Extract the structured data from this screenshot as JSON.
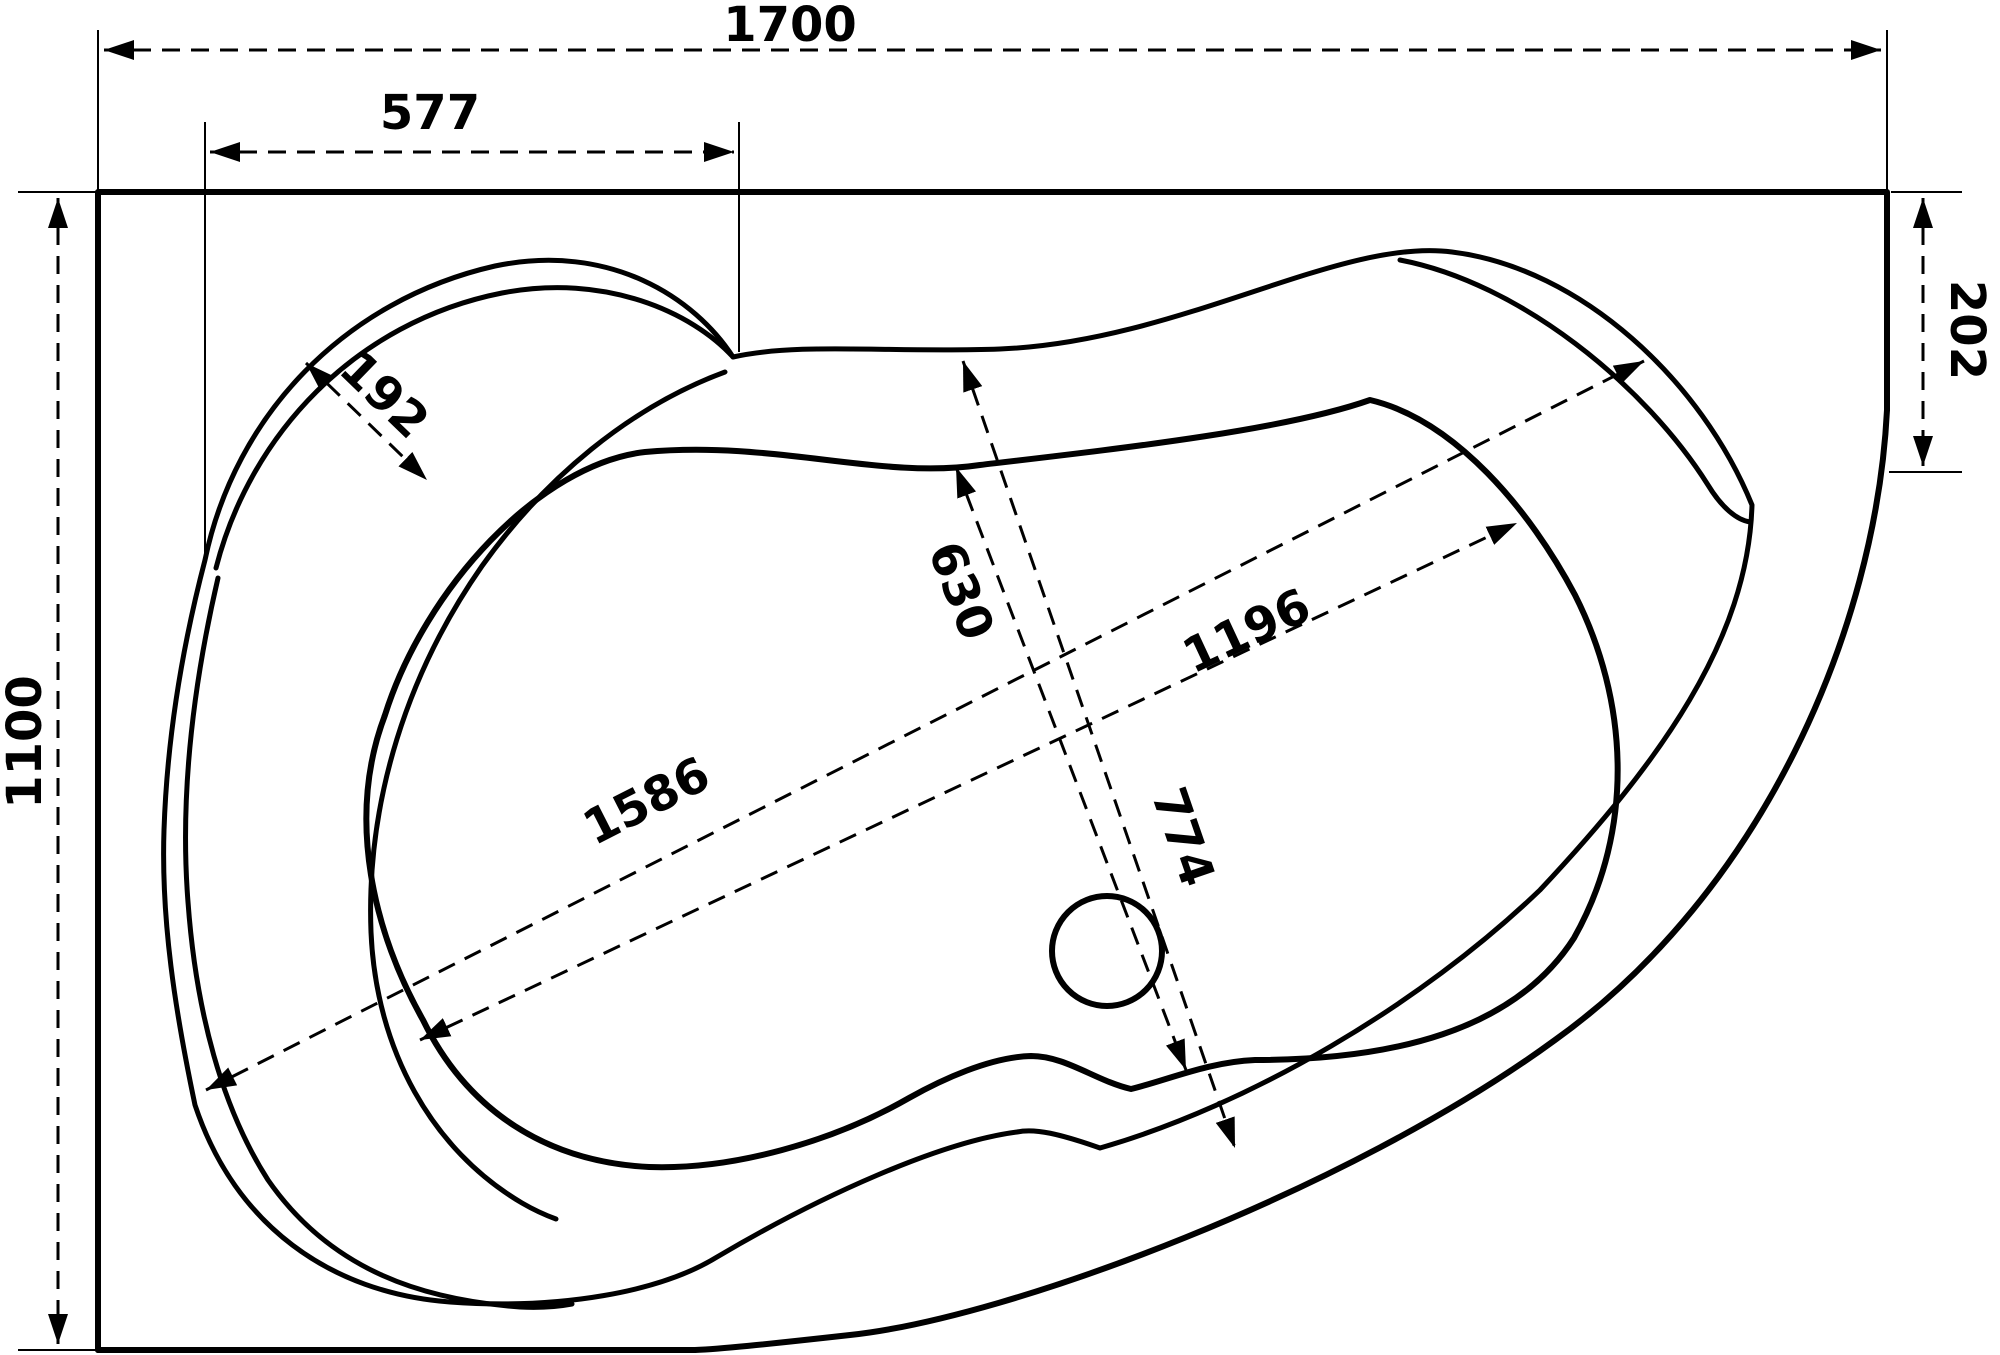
{
  "drawing": {
    "title": "corner-bathtub-top-view-dimension-drawing",
    "background": "#ffffff",
    "line_color": "#000000",
    "canvas": {
      "width": 2000,
      "height": 1355
    },
    "dimension_values": {
      "overall_width": "1700",
      "overall_depth": "1100",
      "corner_shelf_width": "577",
      "shelf_band_width": "192",
      "right_side_depth": "202",
      "bowl_inner_width": "630",
      "rim_width": "774",
      "bowl_inner_length": "1196",
      "overall_diagonal_length": "1586"
    }
  },
  "geometry": {
    "stroke": "#000000",
    "outline_width": 6,
    "thin_width": 5,
    "dim_width": 3,
    "ext_width": 2,
    "dash": "18 11",
    "label_font_size": 48,
    "outline_paths": [
      {
        "name": "tub-wall-edges",
        "d": "M 98,1350 L 98,192 L 1887,192 L 1887,410",
        "w": 6
      },
      {
        "name": "tub-bottom-wall-edge",
        "d": "M 98,1350 L 695,1350",
        "w": 6
      },
      {
        "name": "tub-apron-curve",
        "d": "M 1887,410 C 1876,630 1762,892 1555,1040 C 1350,1190 1010,1318 850,1335 C 760,1345 720,1349 695,1350",
        "w": 6
      },
      {
        "name": "rim-outer-contour",
        "d": "M 205,560 C 235,415 345,300 495,266 C 610,242 695,298 733,357 C 800,342 890,353 1000,349 C 1180,342 1340,237 1452,252 C 1582,268 1702,382 1752,505 C 1748,640 1660,762 1540,890 C 1420,1005 1250,1105 1100,1148 C 1060,1134 1035,1128 1017,1132 C 940,1142 820,1196 717,1257 C 660,1292 560,1310 450,1302 C 330,1293 235,1225 195,1105 C 175,1010 161,920 164,830 C 167,740 182,648 205,560 Z",
        "w": 5
      },
      {
        "name": "shelf-inner-arc",
        "d": "M 216,568 C 250,435 355,322 502,293 C 605,273 692,312 733,357",
        "w": 5
      },
      {
        "name": "rim-left-step",
        "d": "M 218,578 C 192,690 180,800 188,902 C 196,1012 222,1108 268,1180 C 332,1272 425,1300 520,1307 C 540,1308 556,1307 572,1304",
        "w": 5
      },
      {
        "name": "rim-inner-step",
        "d": "M 725,372 C 630,407 545,478 482,566 C 408,672 366,800 371,932 C 376,1050 432,1150 522,1203 C 534,1210 545,1215 556,1219",
        "w": 5
      },
      {
        "name": "rim-right-step",
        "d": "M 1400,260 C 1520,283 1645,385 1708,485 C 1722,508 1737,520 1750,522",
        "w": 5
      },
      {
        "name": "bowl-outline",
        "d": "M 645,452 C 775,440 880,480 980,465 C 1125,448 1285,430 1370,400 C 1455,420 1530,510 1575,595 C 1628,700 1636,828 1574,938 C 1514,1032 1390,1060 1255,1060 C 1208,1062 1168,1080 1131,1089 C 1096,1081 1066,1056 1031,1056 C 990,1057 941,1080 909,1098 C 832,1142 733,1170 649,1167 C 548,1162 468,1112 423,1020 C 375,935 345,820 385,715 C 425,588 540,464 645,452 Z",
        "w": 6
      }
    ],
    "drain_circle": {
      "name": "drain-circle",
      "cx": 1107,
      "cy": 951,
      "r": 55,
      "w": 6
    },
    "dim_lines": [
      {
        "name": "dim-overall-width",
        "label_key": "overall_width",
        "x1": 104,
        "y1": 50,
        "x2": 1881,
        "y2": 50,
        "lx": 790,
        "ly": 28,
        "rot": 0,
        "ext": [
          [
            98,
            30,
            98,
            190
          ],
          [
            1887,
            30,
            1887,
            190
          ]
        ]
      },
      {
        "name": "dim-corner-shelf-width",
        "label_key": "corner_shelf_width",
        "x1": 210,
        "y1": 152,
        "x2": 734,
        "y2": 152,
        "lx": 430,
        "ly": 116,
        "rot": 0,
        "ext": [
          [
            205,
            122,
            205,
            556
          ],
          [
            739,
            122,
            739,
            352
          ]
        ]
      },
      {
        "name": "dim-overall-depth",
        "label_key": "overall_depth",
        "x1": 58,
        "y1": 198,
        "x2": 58,
        "y2": 1344,
        "lx": 28,
        "ly": 742,
        "rot": -90,
        "ext": [
          [
            18,
            192,
            96,
            192
          ],
          [
            18,
            1350,
            96,
            1350
          ]
        ]
      },
      {
        "name": "dim-right-side-depth",
        "label_key": "right_side_depth",
        "x1": 1923,
        "y1": 198,
        "x2": 1923,
        "y2": 466,
        "lx": 1964,
        "ly": 330,
        "rot": 90,
        "ext": [
          [
            1891,
            192,
            1962,
            192
          ],
          [
            1889,
            472,
            1962,
            472
          ]
        ]
      },
      {
        "name": "dim-shelf-band-width",
        "label_key": "shelf_band_width",
        "x1": 306,
        "y1": 363,
        "x2": 427,
        "y2": 480,
        "lx": 382,
        "ly": 397,
        "rot": 44,
        "ext": []
      },
      {
        "name": "dim-overall-diagonal",
        "label_key": "overall_diagonal_length",
        "x1": 206,
        "y1": 1090,
        "x2": 1644,
        "y2": 361,
        "lx": 648,
        "ly": 804,
        "rot": -27,
        "ext": []
      },
      {
        "name": "dim-bowl-length",
        "label_key": "bowl_inner_length",
        "x1": 420,
        "y1": 1040,
        "x2": 1517,
        "y2": 523,
        "lx": 1248,
        "ly": 634,
        "rot": -25,
        "ext": []
      },
      {
        "name": "dim-bowl-width",
        "label_key": "bowl_inner_width",
        "x1": 956,
        "y1": 467,
        "x2": 1186,
        "y2": 1070,
        "lx": 958,
        "ly": 592,
        "rot": 69,
        "ext": []
      },
      {
        "name": "dim-rim-width",
        "label_key": "rim_width",
        "x1": 963,
        "y1": 361,
        "x2": 1235,
        "y2": 1148,
        "lx": 1180,
        "ly": 838,
        "rot": 71,
        "ext": []
      }
    ]
  }
}
